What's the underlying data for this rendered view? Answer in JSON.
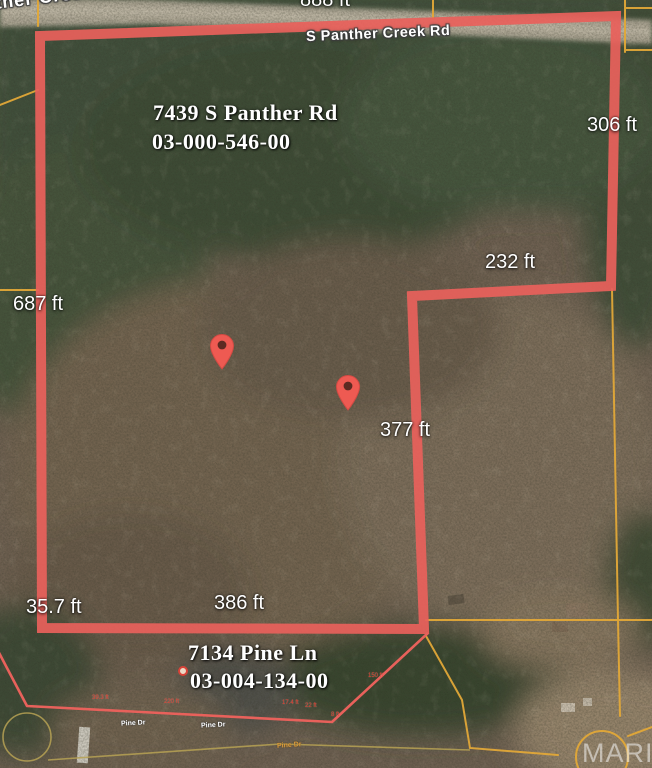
{
  "roads": {
    "partial_top_left": "ther Creek Rd",
    "main": "S Panther Creek Rd",
    "pine_dr_a": "Pine Dr",
    "pine_dr_b": "Pine Dr",
    "pine_dr_c": "Pine Dr"
  },
  "parcels": {
    "panther": {
      "address": "7439 S Panther Rd",
      "parcel_id": "03-000-546-00"
    },
    "pine": {
      "address": "7134 Pine Ln",
      "parcel_id": "03-004-134-00"
    }
  },
  "measurements": {
    "top_clipped": "888 ft",
    "right": "306 ft",
    "step": "232 ft",
    "left": "687 ft",
    "middle": "377 ft",
    "bottom_left": "35.7 ft",
    "bottom": "386 ft",
    "tiny_a": "39.3 ft",
    "tiny_b": "220 ft",
    "tiny_c": "17.4 ft",
    "tiny_d": "22 ft",
    "tiny_e": "150 ft",
    "tiny_f": "8 ft"
  },
  "watermark": "MARIS",
  "colors": {
    "boundary_red": "#e8615b",
    "parcel_orange": "#e2a838",
    "pin_red": "#ee5a52",
    "road_fill": "#b4ab9a"
  }
}
